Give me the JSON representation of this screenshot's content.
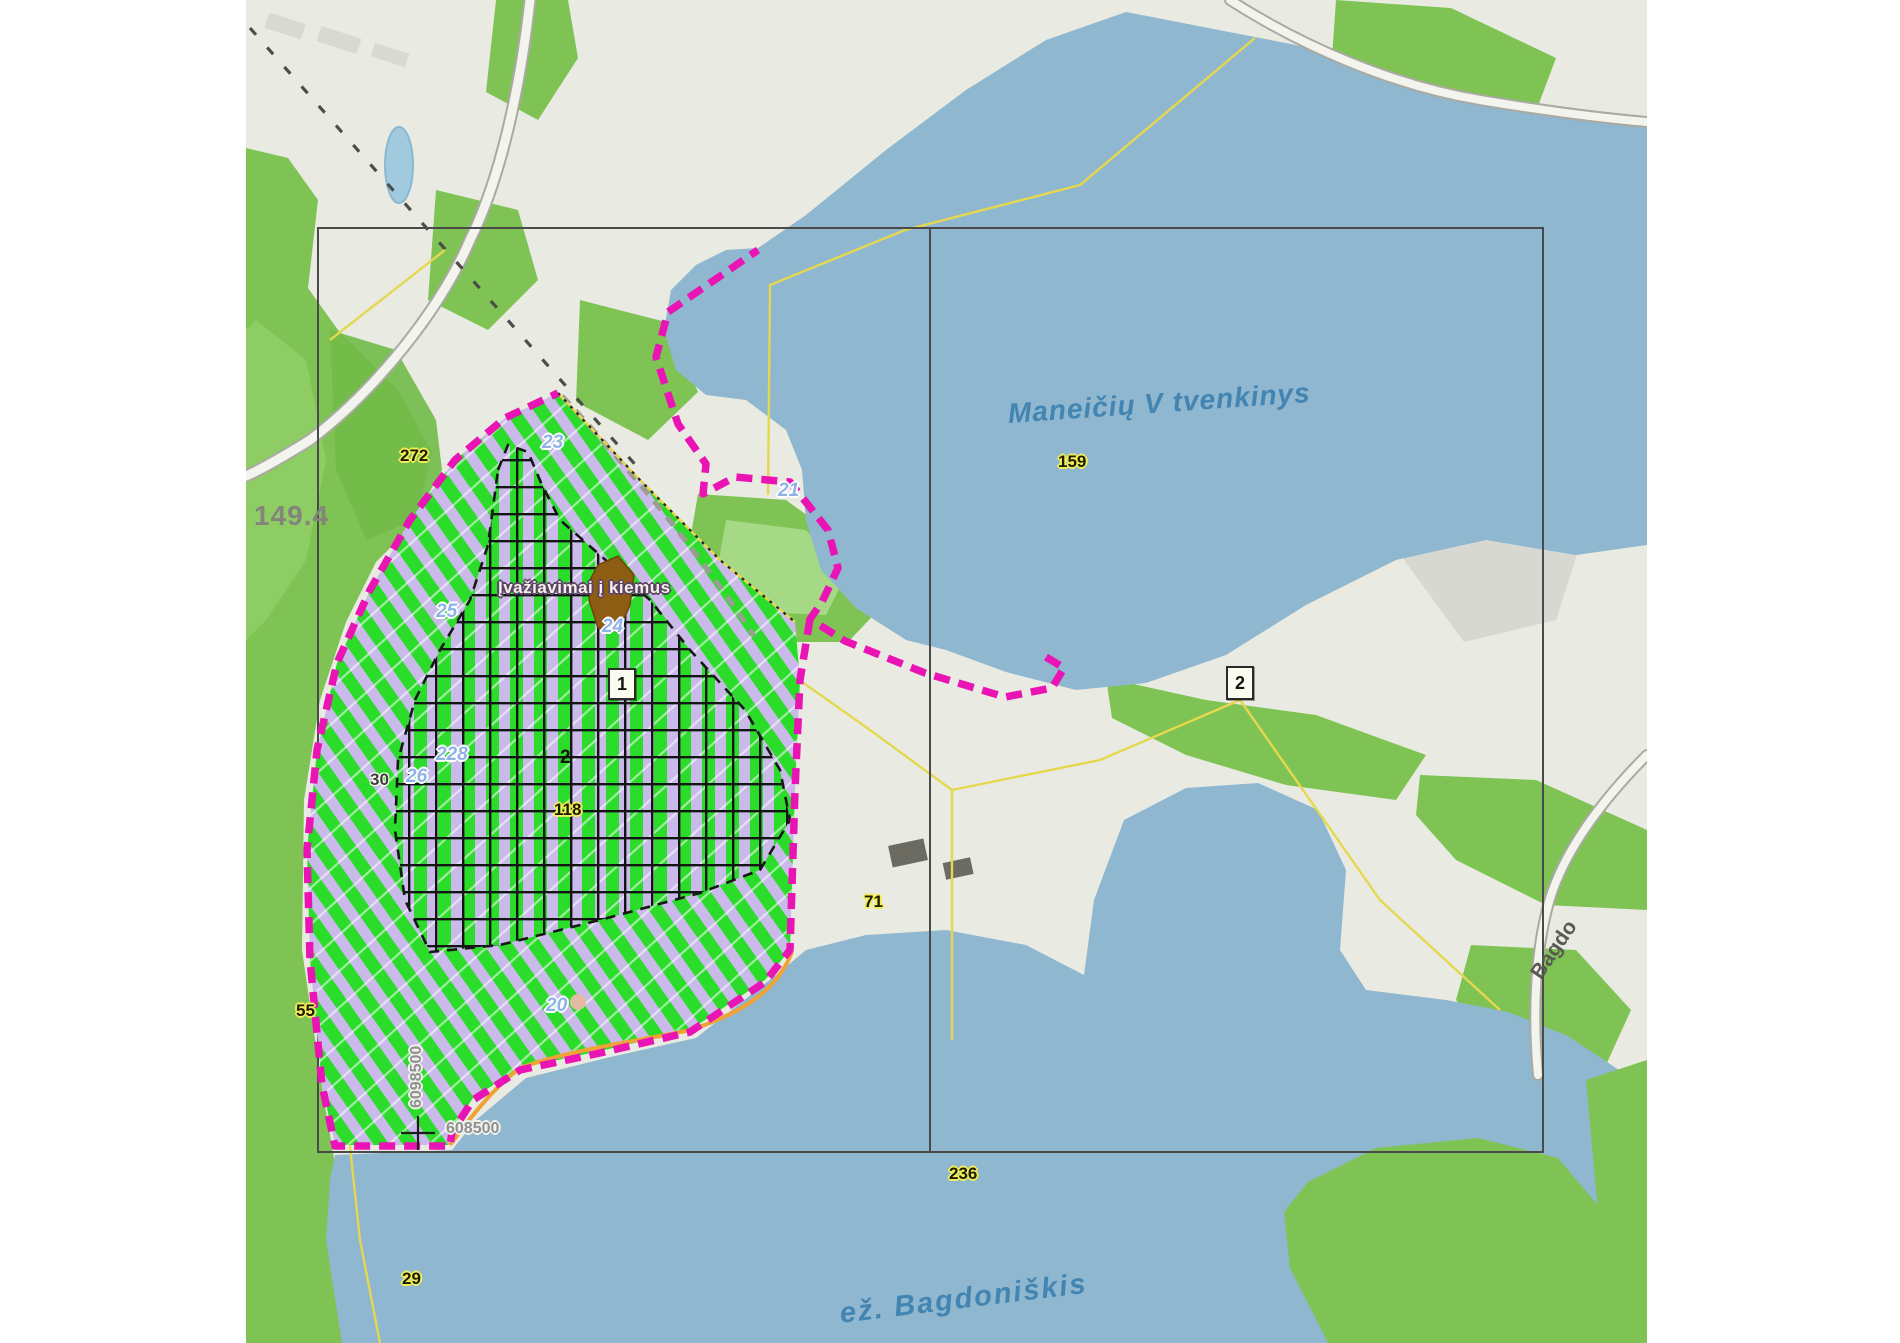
{
  "map": {
    "water_labels": {
      "reservoir": "Maneičių V tvenkinys",
      "lake": "ež. Bagdoniškis"
    },
    "road_label": "Bagdo",
    "entrance_note": "Įvažiavimai į kiemus",
    "parcel_numbers": {
      "p272": "272",
      "p159": "159",
      "p71": "71",
      "p118": "118",
      "p236": "236",
      "p55": "55",
      "p29": "29"
    },
    "plan_numbers": {
      "n23": "23",
      "n24": "24",
      "n21": "21",
      "n25": "25",
      "n26": "26",
      "n228": "228",
      "n20": "20"
    },
    "gray_numbers": {
      "n30": "30",
      "area": "149.4",
      "sub2": "2"
    },
    "markers": {
      "box1": "1",
      "box2": "2"
    },
    "coordinates": {
      "northing": "6098500",
      "easting": "608500"
    },
    "colors": {
      "boundary_magenta": "#ea14b4",
      "water_blue": "#8fb7cf",
      "forest_green": "#7fc355",
      "hatch_green": "#2bdc2b",
      "hatch_lavender": "#c9baea",
      "parcel_line_yellow": "#e6d84e",
      "frame_gray": "#4a4a4a",
      "orange_line": "#f0a235"
    }
  }
}
